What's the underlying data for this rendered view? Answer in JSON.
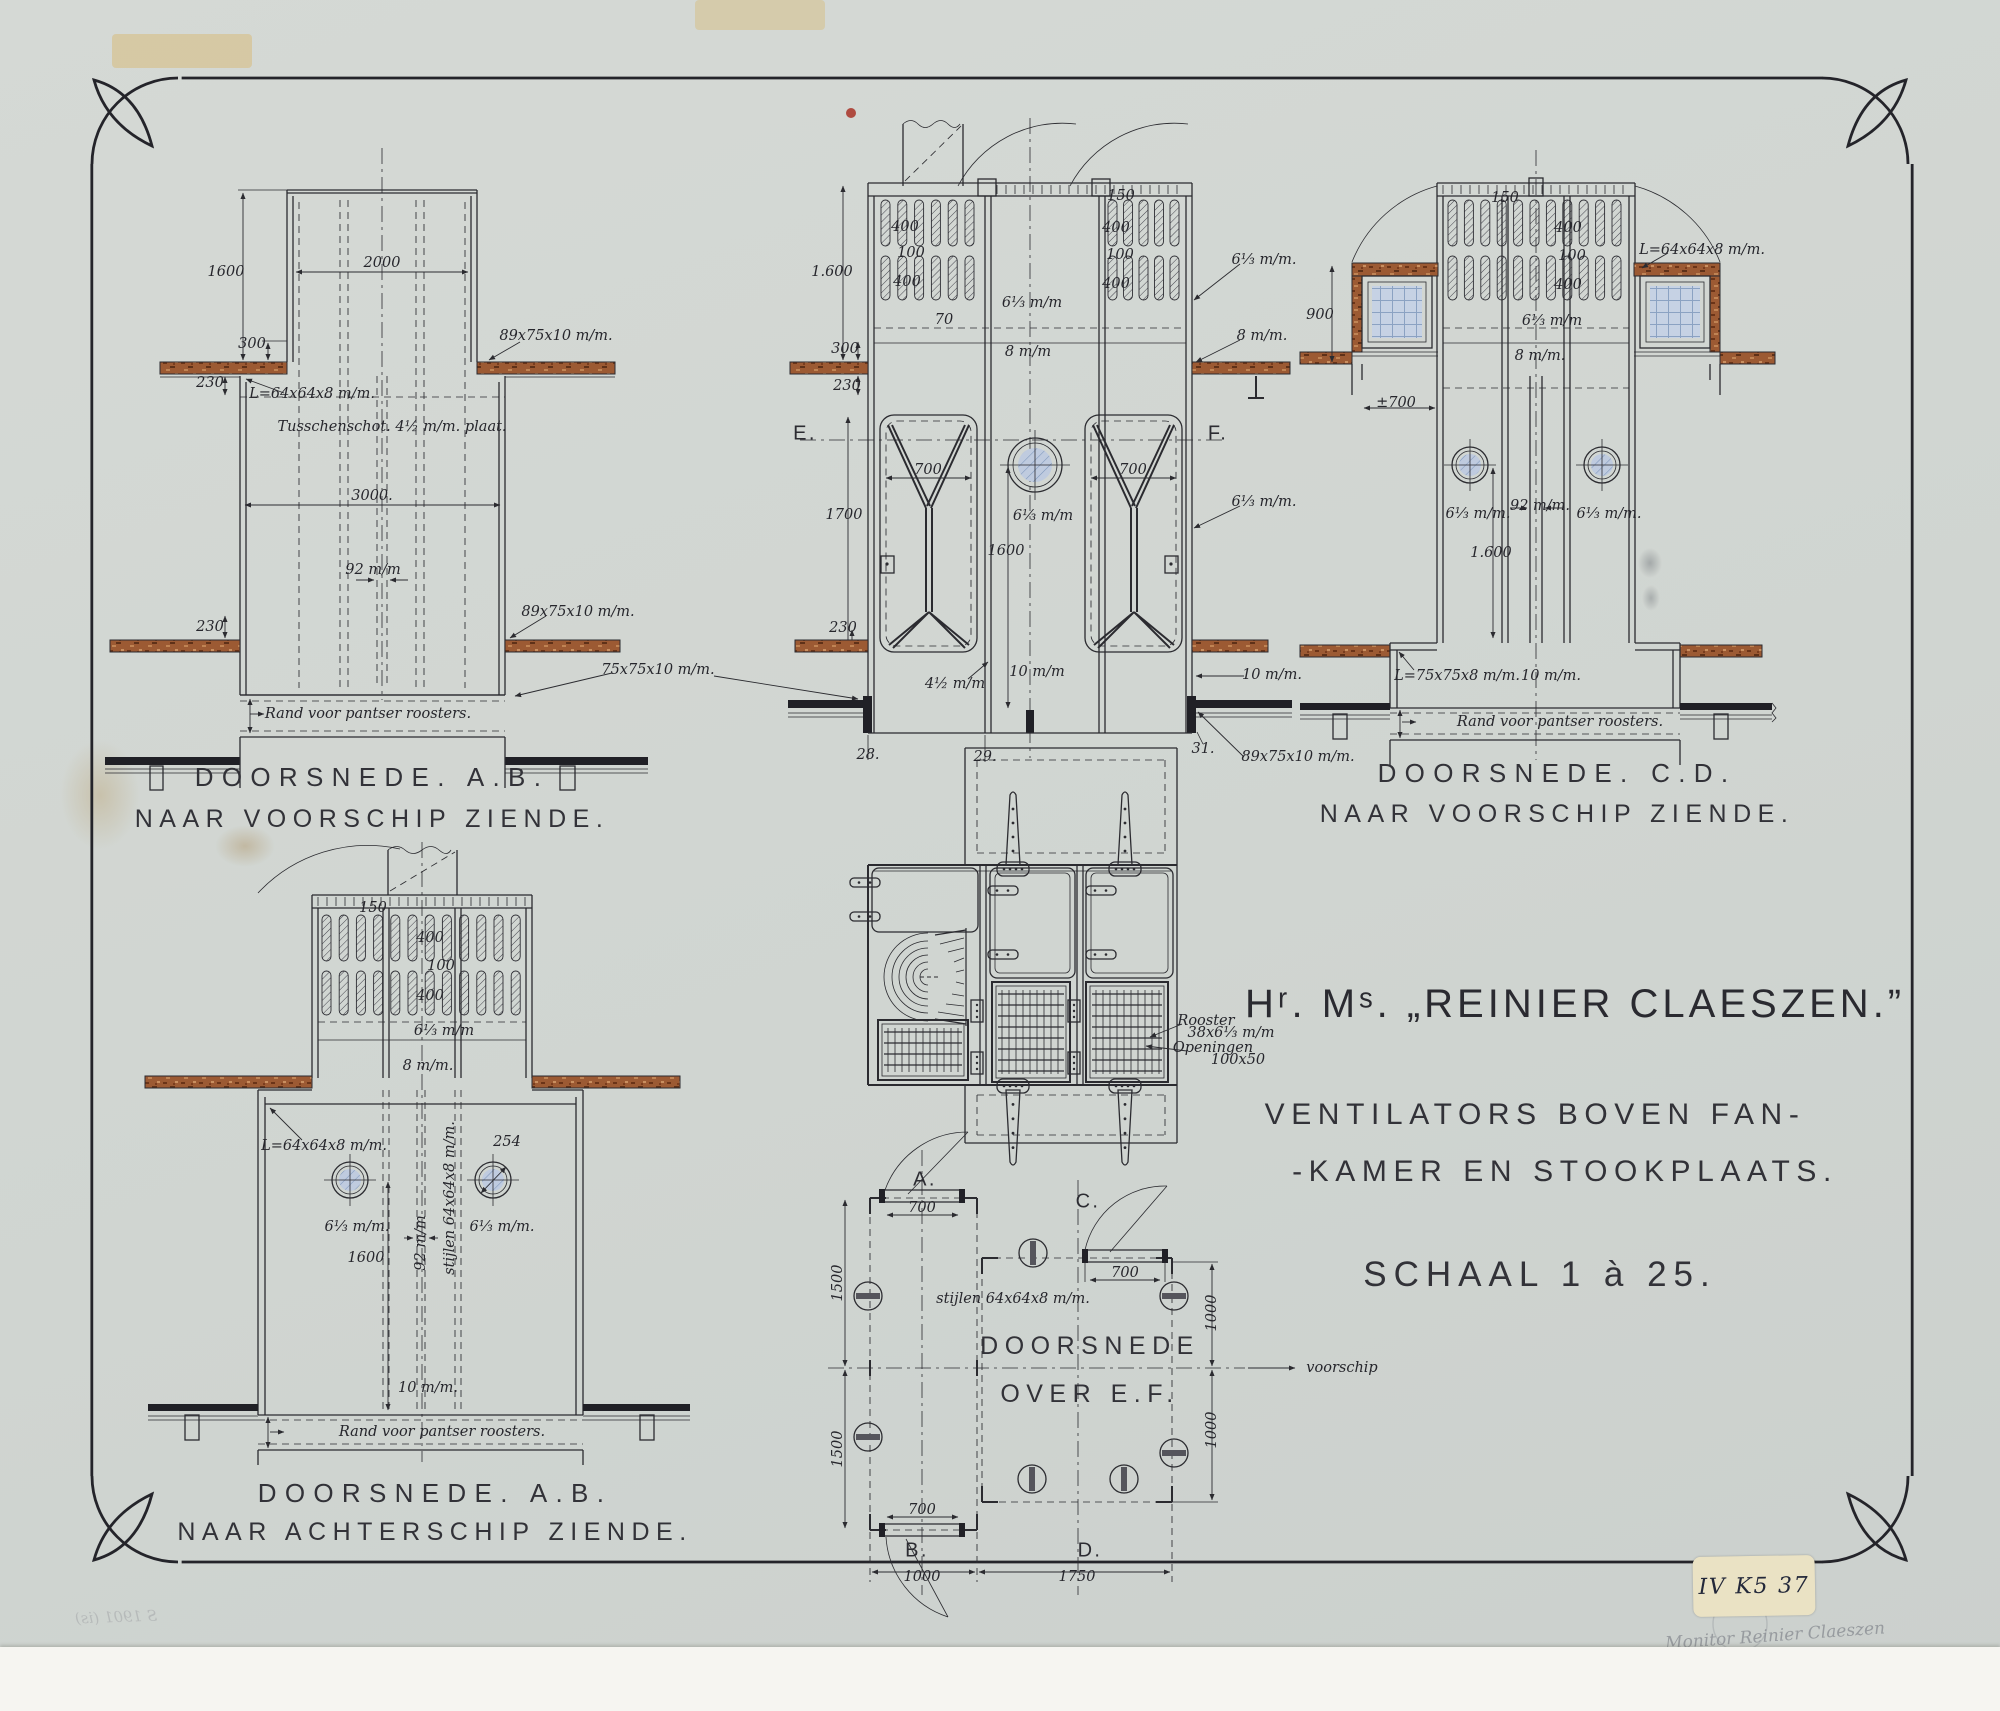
{
  "sheet": {
    "title": "Hʳ. Mˢ. „REINIER CLAESZEN.”",
    "subtitle_line1": "VENTILATORS BOVEN FAN-",
    "subtitle_line2": "-KAMER EN STOOKPLAATS.",
    "scale_text": "SCHAAL 1 à 25.",
    "paper_color": "#d5d9d5",
    "ink_color": "#2b2b30",
    "wood_color": "#9c5a33",
    "glass_color": "#bfcbdf",
    "red_dot_color": "#a83226"
  },
  "captions": {
    "view_ab_fore": {
      "line1": "DOORSNEDE. A.B.",
      "line2": "NAAR VOORSCHIP ZIENDE."
    },
    "view_cd": {
      "line1": "DOORSNEDE. C.D.",
      "line2": "NAAR VOORSCHIP ZIENDE."
    },
    "view_ab_aft": {
      "line1": "DOORSNEDE. A.B.",
      "line2": "NAAR ACHTERSCHIP ZIENDE."
    },
    "plan": {
      "line1": "DOORSNEDE",
      "line2": "OVER E.F."
    }
  },
  "stamp": {
    "label": "IV K5 37"
  },
  "handwriting": {
    "line1": "Monitor Reinier Claeszen",
    "line2": "1890"
  },
  "faint_note": "S 1901 (is)",
  "annotations": [
    {
      "x": 226,
      "y": 272,
      "t": "1600"
    },
    {
      "x": 382,
      "y": 263,
      "t": "2000"
    },
    {
      "x": 252,
      "y": 344,
      "t": "300"
    },
    {
      "x": 210,
      "y": 383,
      "t": "230"
    },
    {
      "x": 556,
      "y": 336,
      "t": "89x75x10 m/m."
    },
    {
      "x": 312,
      "y": 394,
      "t": "L=64x64x8 m/m."
    },
    {
      "x": 392,
      "y": 427,
      "t": "Tusschenschot. 4½ m/m. plaat."
    },
    {
      "x": 372,
      "y": 496,
      "t": "3000."
    },
    {
      "x": 373,
      "y": 570,
      "t": "92 m/m"
    },
    {
      "x": 210,
      "y": 627,
      "t": "230"
    },
    {
      "x": 578,
      "y": 612,
      "t": "89x75x10 m/m."
    },
    {
      "x": 658,
      "y": 670,
      "t": "75x75x10 m/m."
    },
    {
      "x": 368,
      "y": 714,
      "t": "Rand voor pantser roosters."
    },
    {
      "x": 832,
      "y": 272,
      "t": "1.600"
    },
    {
      "x": 845,
      "y": 349,
      "t": "300"
    },
    {
      "x": 847,
      "y": 386,
      "t": "230"
    },
    {
      "x": 905,
      "y": 227,
      "t": "400"
    },
    {
      "x": 911,
      "y": 253,
      "t": "100"
    },
    {
      "x": 907,
      "y": 282,
      "t": "400"
    },
    {
      "x": 944,
      "y": 320,
      "t": "70"
    },
    {
      "x": 1121,
      "y": 196,
      "t": "150"
    },
    {
      "x": 1116,
      "y": 228,
      "t": "400"
    },
    {
      "x": 1120,
      "y": 255,
      "t": "100"
    },
    {
      "x": 1116,
      "y": 284,
      "t": "400"
    },
    {
      "x": 1032,
      "y": 303,
      "t": "6⅓ m/m"
    },
    {
      "x": 1264,
      "y": 260,
      "t": "6⅓ m/m."
    },
    {
      "x": 1028,
      "y": 352,
      "t": "8 m/m"
    },
    {
      "x": 1262,
      "y": 336,
      "t": "8 m/m."
    },
    {
      "x": 805,
      "y": 434,
      "t": "E.",
      "c": "sec"
    },
    {
      "x": 1218,
      "y": 434,
      "t": "F.",
      "c": "sec"
    },
    {
      "x": 844,
      "y": 515,
      "t": "1700"
    },
    {
      "x": 928,
      "y": 470,
      "t": "700"
    },
    {
      "x": 1133,
      "y": 470,
      "t": "700"
    },
    {
      "x": 1043,
      "y": 516,
      "t": "6⅓ m/m"
    },
    {
      "x": 1006,
      "y": 551,
      "t": "1600"
    },
    {
      "x": 1264,
      "y": 502,
      "t": "6⅓ m/m."
    },
    {
      "x": 843,
      "y": 628,
      "t": "230"
    },
    {
      "x": 955,
      "y": 684,
      "t": "4½ m/m"
    },
    {
      "x": 1037,
      "y": 672,
      "t": "10 m/m"
    },
    {
      "x": 1272,
      "y": 675,
      "t": "10 m/m."
    },
    {
      "x": 868,
      "y": 755,
      "t": "28."
    },
    {
      "x": 985,
      "y": 757,
      "t": "29."
    },
    {
      "x": 1203,
      "y": 749,
      "t": "31."
    },
    {
      "x": 1298,
      "y": 757,
      "t": "89x75x10 m/m."
    },
    {
      "x": 1320,
      "y": 315,
      "t": "900"
    },
    {
      "x": 1505,
      "y": 198,
      "t": "150"
    },
    {
      "x": 1568,
      "y": 228,
      "t": "400"
    },
    {
      "x": 1572,
      "y": 256,
      "t": "100"
    },
    {
      "x": 1568,
      "y": 285,
      "t": "400"
    },
    {
      "x": 1702,
      "y": 250,
      "t": "L=64x64x8 m/m."
    },
    {
      "x": 1552,
      "y": 321,
      "t": "6⅓ m/m"
    },
    {
      "x": 1540,
      "y": 356,
      "t": "8 m/m."
    },
    {
      "x": 1396,
      "y": 403,
      "t": "±700"
    },
    {
      "x": 1478,
      "y": 514,
      "t": "6⅓ m/m."
    },
    {
      "x": 1540,
      "y": 506,
      "t": "92 m/m."
    },
    {
      "x": 1609,
      "y": 514,
      "t": "6⅓ m/m."
    },
    {
      "x": 1491,
      "y": 553,
      "t": "1.600"
    },
    {
      "x": 1457,
      "y": 676,
      "t": "L=75x75x8 m/m."
    },
    {
      "x": 1551,
      "y": 676,
      "t": "10 m/m."
    },
    {
      "x": 1560,
      "y": 722,
      "t": "Rand voor pantser roosters."
    },
    {
      "x": 373,
      "y": 908,
      "t": "150"
    },
    {
      "x": 430,
      "y": 938,
      "t": "400"
    },
    {
      "x": 441,
      "y": 966,
      "t": "100"
    },
    {
      "x": 430,
      "y": 996,
      "t": "400"
    },
    {
      "x": 444,
      "y": 1031,
      "t": "6⅓ m/m"
    },
    {
      "x": 428,
      "y": 1066,
      "t": "8 m/m."
    },
    {
      "x": 324,
      "y": 1146,
      "t": "L=64x64x8 m/m."
    },
    {
      "x": 507,
      "y": 1142,
      "t": "254"
    },
    {
      "x": 357,
      "y": 1227,
      "t": "6⅓ m/m."
    },
    {
      "x": 502,
      "y": 1227,
      "t": "6⅓ m/m."
    },
    {
      "x": 421,
      "y": 1243,
      "t": "92 m/m",
      "r": -90
    },
    {
      "x": 450,
      "y": 1198,
      "t": "stijlen 64x64x8 m/m.",
      "r": -90
    },
    {
      "x": 366,
      "y": 1258,
      "t": "1600"
    },
    {
      "x": 428,
      "y": 1388,
      "t": "10 m/m."
    },
    {
      "x": 442,
      "y": 1432,
      "t": "Rand voor pantser roosters."
    },
    {
      "x": 1206,
      "y": 1021,
      "t": "Rooster"
    },
    {
      "x": 1231,
      "y": 1033,
      "t": "38x6⅓ m/m"
    },
    {
      "x": 1213,
      "y": 1048,
      "t": "Openingen"
    },
    {
      "x": 1238,
      "y": 1060,
      "t": "100x50"
    },
    {
      "x": 925,
      "y": 1180,
      "t": "A.",
      "c": "sec"
    },
    {
      "x": 1088,
      "y": 1202,
      "t": "C.",
      "c": "sec"
    },
    {
      "x": 922,
      "y": 1208,
      "t": "700"
    },
    {
      "x": 1125,
      "y": 1273,
      "t": "700"
    },
    {
      "x": 838,
      "y": 1283,
      "t": "1500",
      "r": -90
    },
    {
      "x": 838,
      "y": 1449,
      "t": "1500",
      "r": -90
    },
    {
      "x": 1212,
      "y": 1313,
      "t": "1000",
      "r": -90
    },
    {
      "x": 1212,
      "y": 1430,
      "t": "1000",
      "r": -90
    },
    {
      "x": 1013,
      "y": 1299,
      "t": "stijlen 64x64x8 m/m."
    },
    {
      "x": 1342,
      "y": 1368,
      "t": "voorschip"
    },
    {
      "x": 917,
      "y": 1551,
      "t": "B.",
      "c": "sec"
    },
    {
      "x": 1090,
      "y": 1551,
      "t": "D.",
      "c": "sec"
    },
    {
      "x": 922,
      "y": 1510,
      "t": "700"
    },
    {
      "x": 922,
      "y": 1577,
      "t": "1000"
    },
    {
      "x": 1077,
      "y": 1577,
      "t": "1750"
    }
  ]
}
